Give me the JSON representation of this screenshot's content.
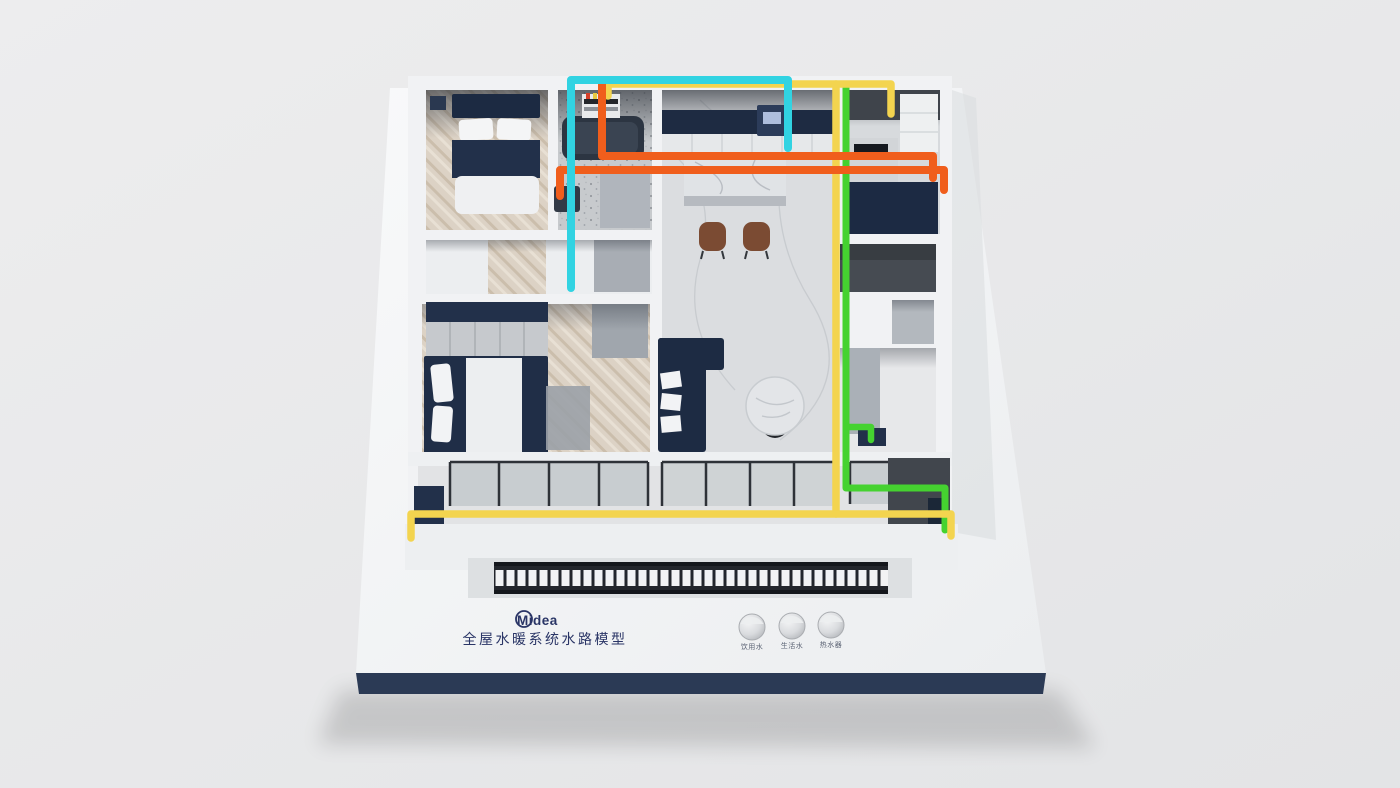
{
  "branding": {
    "brand": "Midea",
    "title": "全屋水暖系统水路模型",
    "brand_color": "#2a3566"
  },
  "controls": {
    "knobs": [
      {
        "label": "饮用水"
      },
      {
        "label": "生活水"
      },
      {
        "label": "热水器"
      }
    ]
  },
  "pipes": {
    "cyan": {
      "color": "#31d3e2"
    },
    "orange": {
      "color": "#f05e1c"
    },
    "yellow": {
      "color": "#f3d44f"
    },
    "green": {
      "color": "#45d230"
    }
  },
  "base": {
    "edge_color": "#2b3a55"
  }
}
